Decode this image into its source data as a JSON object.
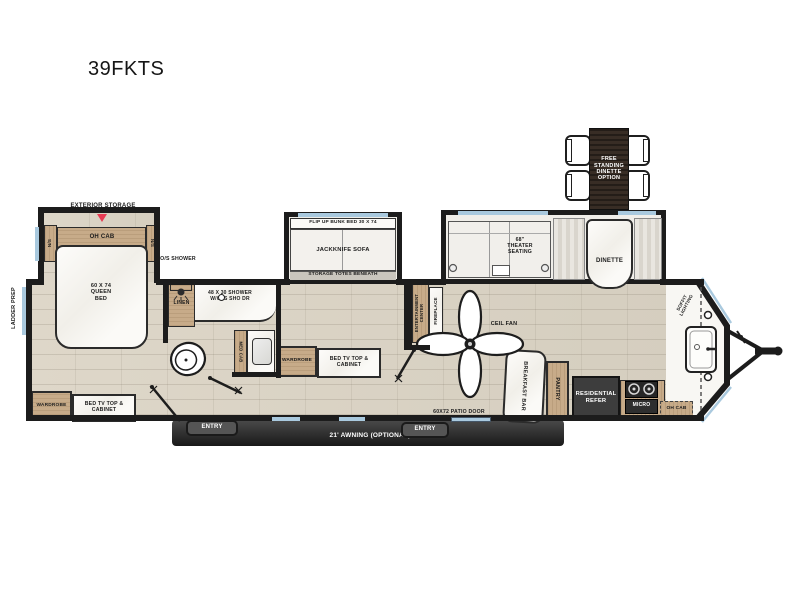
{
  "title": "39FKTS",
  "inset": {
    "label": "FREE STANDING DINETTE OPTION"
  },
  "exterior": {
    "ladder_prep": "LADDER PREP",
    "exterior_storage": "EXTERIOR STORAGE",
    "awning": "21' AWNING (OPTIONAL)",
    "entry_left": "ENTRY",
    "entry_right": "ENTRY",
    "patio_door": "60X72 PATIO DOOR",
    "soffit_lighting": "SOFFIT LIGHTING"
  },
  "bedroom": {
    "ns_left": "N/S",
    "ns_right": "N/S",
    "oh_cab": "OH CAB",
    "queen_bed": "60 X 74 QUEEN BED",
    "wardrobe": "WARDROBE",
    "bed_tv": "BED TV TOP & CABINET"
  },
  "bathroom": {
    "os_shower": "O/S SHOWER",
    "linen": "LINEN",
    "shower": "48 X 30 SHOWER W/GLS SHO DR",
    "med_cab": "MED CAB"
  },
  "bunk_room": {
    "flip_bunk": "FLIP UP BUNK BED 30 X 74",
    "sofa": "JACKKNIFE SOFA",
    "storage": "STORAGE TOTES BENEATH",
    "wardrobe": "WARDROBE",
    "bed_tv": "BED TV TOP & CABINET"
  },
  "living": {
    "ent_center": "ENTERTAINMENT CENTER",
    "fireplace": "FIREPLACE",
    "ceil_fan": "CEIL FAN",
    "theater": "68\" THEATER SEATING",
    "dinette": "DINETTE"
  },
  "kitchen": {
    "breakfast_bar": "BREAKFAST BAR",
    "pantry": "PANTRY",
    "refer": "RESIDENTIAL REFER",
    "micro": "MICRO",
    "oh_cab": "OH CAB"
  },
  "colors": {
    "wall": "#1c1c1c",
    "floor": "#d9d2c4",
    "cabinet_wood": "#c7ab89",
    "accent_red": "#e73a52",
    "window_blue": "#a9c9de",
    "appliance_dark": "#3d3d3d"
  }
}
